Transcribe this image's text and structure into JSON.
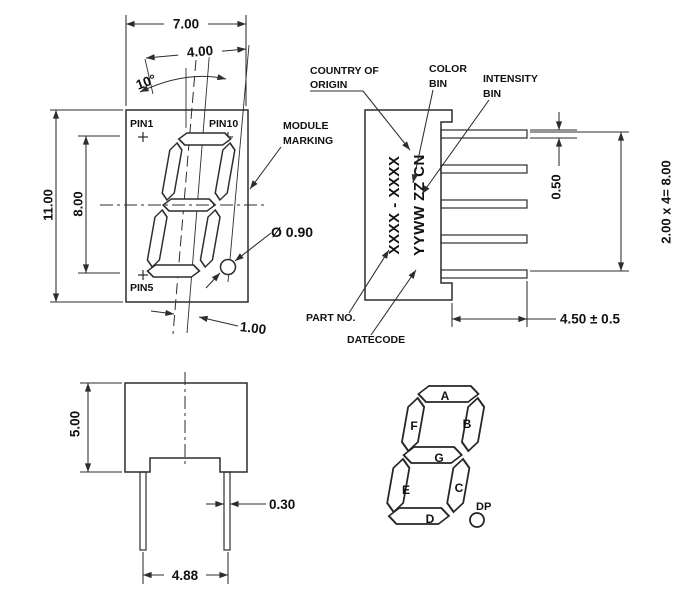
{
  "front_view": {
    "dim_width": "7.00",
    "dim_digit_width": "4.00",
    "dim_angle": "10°",
    "dim_height": "11.00",
    "dim_digit_height": "8.00",
    "dim_dp_offset": "1.00",
    "dim_dp_diameter": "Ø 0.90",
    "pin1": "PIN1",
    "pin10": "PIN10",
    "pin5": "PIN5",
    "module_marking_line1": "MODULE",
    "module_marking_line2": "MARKING"
  },
  "side_view": {
    "label_country_line1": "COUNTRY OF",
    "label_country_line2": "ORIGIN",
    "label_color_line1": "COLOR",
    "label_color_line2": "BIN",
    "label_intensity_line1": "INTENSITY",
    "label_intensity_line2": "BIN",
    "label_part_no": "PART NO.",
    "label_datecode": "DATECODE",
    "marking_part": "XXXX - XXXX",
    "marking_date": "YYWW ZZ CN",
    "dim_pin_thickness": "0.50",
    "dim_pin_pitch": "2.00 x 4= 8.00",
    "dim_pin_length": "4.50 ± 0.5"
  },
  "bottom_view": {
    "dim_height": "5.00",
    "dim_pin_width": "0.30",
    "dim_pin_span": "4.88"
  },
  "segment_diagram": {
    "seg_a": "A",
    "seg_b": "B",
    "seg_c": "C",
    "seg_d": "D",
    "seg_e": "E",
    "seg_f": "F",
    "seg_g": "G",
    "dp": "DP"
  },
  "colors": {
    "line": "#2d2d2d",
    "text": "#111111",
    "background": "#ffffff"
  }
}
